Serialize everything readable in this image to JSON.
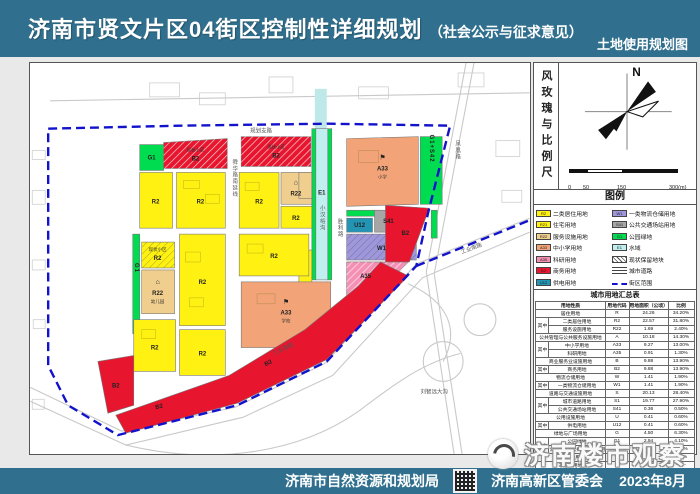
{
  "header": {
    "title": "济南市贤文片区04街区控制性详细规划",
    "subtitle": "（社会公示与征求意见）",
    "map_type_label": "土地使用规划图"
  },
  "footer": {
    "org1": "济南市自然资源和规划局",
    "org2": "济南高新区管委会",
    "date": "2023年8月",
    "qr_icon": "qr-code"
  },
  "watermark": {
    "text": "济南楼市观察",
    "logo_icon": "swirl-logo"
  },
  "colors": {
    "header_bar": "#30708E",
    "boundary": "#1212CC",
    "residential_R2": "#FFF212",
    "service_R22": "#F0CE8E",
    "school_A33": "#F2A478",
    "research_A35": "#F590B4",
    "business_B2": "#E8152E",
    "logistics_W1": "#9F97DC",
    "transit_S41": "#A6A6A6",
    "power_U12": "#2494B4",
    "green_G1": "#00DC50",
    "water_E1": "#BFEFEF"
  },
  "windrose": {
    "panel_label": "风玫瑰与比例尺",
    "north": "N",
    "scale_ticks": [
      "0",
      "50",
      "150",
      "300(m)"
    ]
  },
  "legend": {
    "title": "图例",
    "items": [
      {
        "code": "R2",
        "label": "二类居住用地"
      },
      {
        "code": "W1",
        "label": "一类物流仓储用地"
      },
      {
        "code": "R21",
        "label": "住宅用地"
      },
      {
        "code": "S41",
        "label": "公共交通场站用地"
      },
      {
        "code": "R22",
        "label": "服务设施用地"
      },
      {
        "code": "G1",
        "label": "公园绿地"
      },
      {
        "code": "A33",
        "label": "中小学用地"
      },
      {
        "code": "E1",
        "label": "水域"
      },
      {
        "code": "A35",
        "label": "科研用地"
      },
      {
        "code": "",
        "label": "现状保留地块"
      },
      {
        "code": "B2",
        "label": "商务用地"
      },
      {
        "code": "",
        "label": "城市道路"
      },
      {
        "code": "U12",
        "label": "供电用地"
      },
      {
        "code": "",
        "label": "街区范围"
      }
    ]
  },
  "table": {
    "title": "城市用地汇总表",
    "headers": [
      "用地性质",
      "用地代码",
      "用地面积（公顷）",
      "比例"
    ],
    "among_label": "其中",
    "rows": [
      {
        "name": "居住用地",
        "code": "R",
        "area": "24.26",
        "pct": "34.20%"
      },
      {
        "group": "其中",
        "name": "二类居住用地",
        "code": "R2",
        "area": "22.57",
        "pct": "31.80%"
      },
      {
        "name": "服务设施用地",
        "code": "R22",
        "area": "1.69",
        "pct": "2.40%"
      },
      {
        "name": "公共管理与公共服务设施用地",
        "code": "A",
        "area": "10.18",
        "pct": "14.30%"
      },
      {
        "group": "其中",
        "name": "中小学用地",
        "code": "A33",
        "area": "9.27",
        "pct": "13.00%"
      },
      {
        "name": "科研用地",
        "code": "A35",
        "area": "0.91",
        "pct": "1.30%"
      },
      {
        "name": "商业服务业设施用地",
        "code": "B",
        "area": "9.88",
        "pct": "13.90%"
      },
      {
        "group": "其中",
        "name": "商务用地",
        "code": "B2",
        "area": "9.88",
        "pct": "13.90%"
      },
      {
        "name": "物流仓储用地",
        "code": "W",
        "area": "1.41",
        "pct": "1.90%"
      },
      {
        "group": "其中",
        "name": "一类物流仓储用地",
        "code": "W1",
        "area": "1.41",
        "pct": "1.90%"
      },
      {
        "name": "道路与交通设施用地",
        "code": "S",
        "area": "20.13",
        "pct": "28.40%"
      },
      {
        "group": "其中",
        "name": "城市道路用地",
        "code": "S1",
        "area": "19.77",
        "pct": "27.90%"
      },
      {
        "name": "公共交通场站用地",
        "code": "S41",
        "area": "0.36",
        "pct": "0.50%"
      },
      {
        "name": "公用设施用地",
        "code": "U",
        "area": "0.41",
        "pct": "0.60%"
      },
      {
        "group": "其中",
        "name": "供电用地",
        "code": "U12",
        "area": "0.41",
        "pct": "0.60%"
      },
      {
        "name": "绿地与广场用地",
        "code": "G",
        "area": "4.50",
        "pct": "6.30%"
      },
      {
        "group": "其中",
        "name": "公园绿地",
        "code": "G1",
        "area": "2.94",
        "pct": "4.10%"
      },
      {
        "name": "公园绿地+公共交通场站用地",
        "code": "G1+S42",
        "area": "1.56",
        "pct": "2.20%"
      },
      {
        "name": "城市建设用地",
        "code": "",
        "area": "70.76",
        "pct": "100%"
      },
      {
        "name": "非建设用地",
        "code": "E",
        "area": "1.25",
        "pct": "——"
      },
      {
        "group": "其中",
        "name": "水域",
        "code": "E1",
        "area": "1.25",
        "pct": "——"
      },
      {
        "name": "街区用地",
        "code": "",
        "area": "72.01",
        "pct": "——"
      }
    ]
  },
  "map": {
    "roads": {
      "top": "规划支路",
      "right": "凤凰路",
      "bottom": "工业南路",
      "bottom2": "工业南路",
      "center": "舜华路南延线",
      "mid": "胜利路",
      "stream": "小汉峪沟",
      "ditch": "刘智远大沟"
    },
    "parcels": [
      {
        "code": "G1"
      },
      {
        "code": "B2",
        "name": "现状小区"
      },
      {
        "code": "B2",
        "name": "现状小区"
      },
      {
        "code": "A33",
        "name": "小学",
        "icon": "⚑"
      },
      {
        "code": "G1+S42"
      },
      {
        "code": "E1"
      },
      {
        "code": "R2"
      },
      {
        "code": "R2"
      },
      {
        "code": "R2"
      },
      {
        "code": "R22",
        "icon": "⌂"
      },
      {
        "code": "R2"
      },
      {
        "code": "U12"
      },
      {
        "code": "S41"
      },
      {
        "code": "W1"
      },
      {
        "code": "A35"
      },
      {
        "code": "B2"
      },
      {
        "code": "G1"
      },
      {
        "code": "R2",
        "name": "现状小区"
      },
      {
        "code": "R22",
        "name": "幼儿园",
        "icon": "⌂"
      },
      {
        "code": "R2"
      },
      {
        "code": "R2"
      },
      {
        "code": "R2"
      },
      {
        "code": "R2"
      },
      {
        "code": "A33",
        "name": "学校",
        "icon": "⚑"
      },
      {
        "code": "B2"
      },
      {
        "code": "B2"
      }
    ]
  }
}
